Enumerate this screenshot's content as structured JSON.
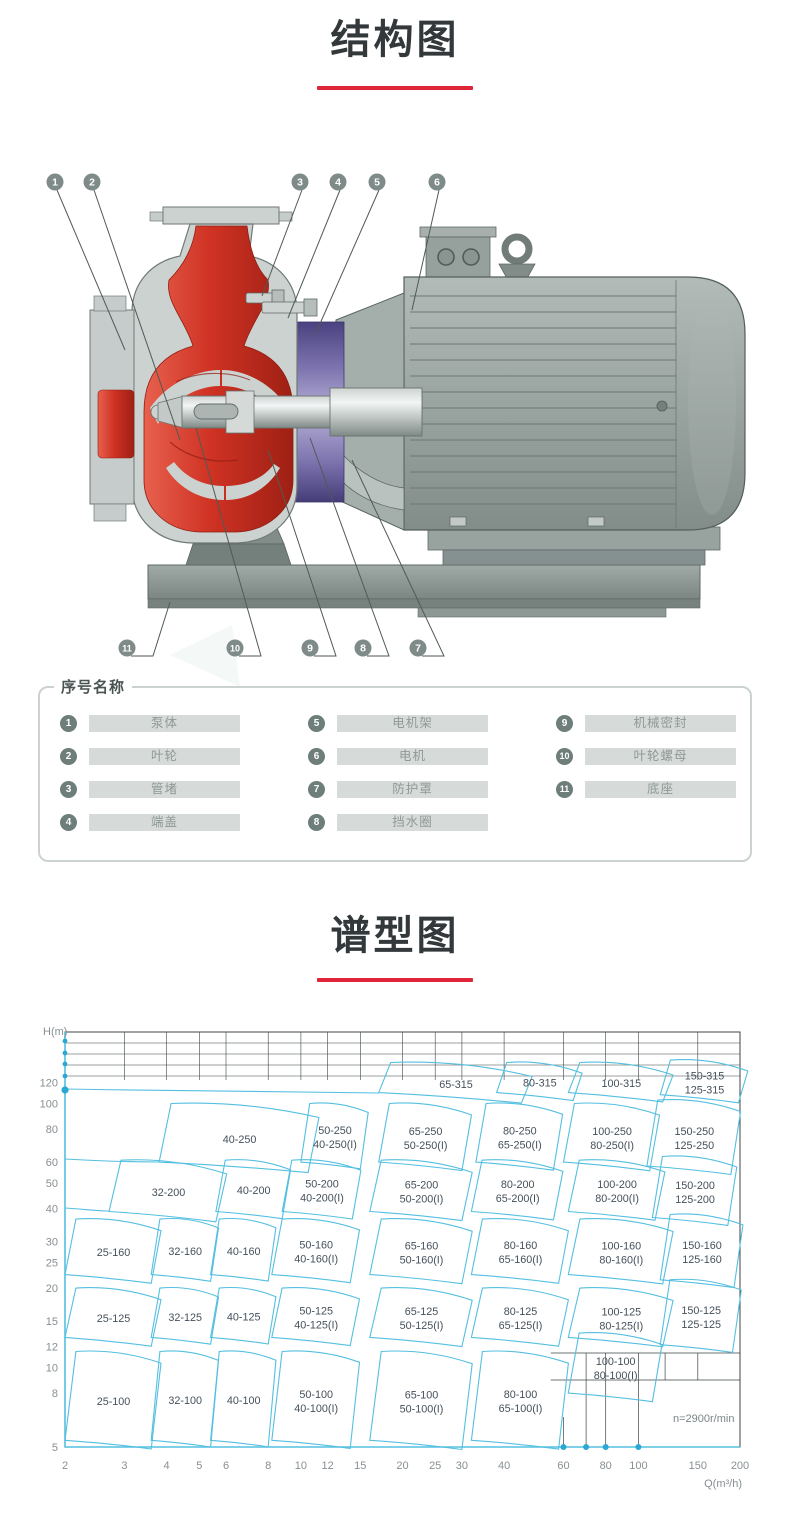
{
  "titles": {
    "structure": "结构图",
    "type_chart": "谱型图"
  },
  "colors": {
    "accent_red": "#e0243a",
    "chart_line": "#54bfe0",
    "chart_dot": "#2ba7d4",
    "grid_black": "#3d4546",
    "region_text": "#45505a",
    "tick_text": "#878f93"
  },
  "legend": {
    "title": "序号名称",
    "columns": [
      [
        {
          "num": "1",
          "label": "泵体"
        },
        {
          "num": "2",
          "label": "叶轮"
        },
        {
          "num": "3",
          "label": "管堵"
        },
        {
          "num": "4",
          "label": "端盖"
        }
      ],
      [
        {
          "num": "5",
          "label": "电机架"
        },
        {
          "num": "6",
          "label": "电机"
        },
        {
          "num": "7",
          "label": "防护罩"
        },
        {
          "num": "8",
          "label": "挡水圈"
        }
      ],
      [
        {
          "num": "9",
          "label": "机械密封"
        },
        {
          "num": "10",
          "label": "叶轮螺母"
        },
        {
          "num": "11",
          "label": "底座"
        }
      ]
    ]
  },
  "pump": {
    "callouts_top": [
      {
        "n": "1",
        "cx": 55,
        "cy": 32,
        "tx": 125,
        "ty": 200
      },
      {
        "n": "2",
        "cx": 92,
        "cy": 32,
        "tx": 180,
        "ty": 290
      },
      {
        "n": "3",
        "cx": 300,
        "cy": 32,
        "tx": 262,
        "ty": 146
      },
      {
        "n": "4",
        "cx": 338,
        "cy": 32,
        "tx": 288,
        "ty": 168
      },
      {
        "n": "5",
        "cx": 377,
        "cy": 32,
        "tx": 315,
        "ty": 185
      },
      {
        "n": "6",
        "cx": 437,
        "cy": 32,
        "tx": 412,
        "ty": 160
      }
    ],
    "callouts_bottom": [
      {
        "n": "11",
        "cx": 127,
        "cy": 498,
        "tx": 170,
        "ty": 452
      },
      {
        "n": "10",
        "cx": 235,
        "cy": 498,
        "tx": 196,
        "ty": 278
      },
      {
        "n": "9",
        "cx": 310,
        "cy": 498,
        "tx": 268,
        "ty": 300
      },
      {
        "n": "8",
        "cx": 363,
        "cy": 498,
        "tx": 310,
        "ty": 288
      },
      {
        "n": "7",
        "cx": 418,
        "cy": 498,
        "tx": 352,
        "ty": 310
      }
    ]
  },
  "chart_data": {
    "type": "region-map",
    "x_axis": {
      "label": "Q(m³/h)",
      "scale": "log",
      "range": [
        2,
        200
      ],
      "ticks": [
        2,
        3,
        4,
        5,
        6,
        8,
        10,
        12,
        15,
        20,
        25,
        30,
        40,
        60,
        80,
        100,
        150,
        200
      ]
    },
    "y_axis": {
      "label": "H(m)",
      "scale": "log",
      "range": [
        5,
        140
      ],
      "ticks": [
        5,
        8,
        10,
        12,
        15,
        20,
        25,
        30,
        40,
        50,
        60,
        80,
        100,
        120
      ]
    },
    "annotation": "n=2900r/min",
    "axis_dots_q": [
      60,
      70,
      80,
      100
    ],
    "regions": [
      {
        "labels": [
          "65-315"
        ],
        "q": [
          17,
          45
        ],
        "h": [
          110,
          143
        ]
      },
      {
        "labels": [
          "80-315"
        ],
        "q": [
          38,
          64
        ],
        "h": [
          110,
          143
        ]
      },
      {
        "labels": [
          "100-315"
        ],
        "q": [
          62,
          118
        ],
        "h": [
          110,
          143
        ]
      },
      {
        "labels": [
          "150-315",
          "125-315"
        ],
        "q": [
          116,
          198
        ],
        "h": [
          108,
          146
        ]
      },
      {
        "labels": [
          "40-250"
        ],
        "q": [
          3.8,
          10.5
        ],
        "h": [
          60,
          100
        ]
      },
      {
        "labels": [
          "50-250",
          "40-250(I)"
        ],
        "q": [
          10,
          15
        ],
        "h": [
          60,
          100
        ]
      },
      {
        "labels": [
          "65-250",
          "50-250(I)"
        ],
        "q": [
          17,
          30
        ],
        "h": [
          60,
          100
        ]
      },
      {
        "labels": [
          "80-250",
          "65-250(I)"
        ],
        "q": [
          33,
          56
        ],
        "h": [
          60,
          100
        ]
      },
      {
        "labels": [
          "100-250",
          "80-250(I)"
        ],
        "q": [
          60,
          108
        ],
        "h": [
          60,
          100
        ]
      },
      {
        "labels": [
          "150-250",
          "125-250"
        ],
        "q": [
          106,
          188
        ],
        "h": [
          58,
          103
        ]
      },
      {
        "labels": [
          "32-200"
        ],
        "q": [
          2.7,
          5.6
        ],
        "h": [
          39,
          61
        ]
      },
      {
        "labels": [
          "40-200"
        ],
        "q": [
          5.6,
          8.8
        ],
        "h": [
          39,
          61
        ]
      },
      {
        "labels": [
          "50-200",
          "40-200(I)"
        ],
        "q": [
          8.8,
          14.2
        ],
        "h": [
          39,
          61
        ]
      },
      {
        "labels": [
          "65-200",
          "50-200(I)"
        ],
        "q": [
          16,
          30
        ],
        "h": [
          39,
          61
        ]
      },
      {
        "labels": [
          "80-200",
          "65-200(I)"
        ],
        "q": [
          32,
          56
        ],
        "h": [
          39,
          61
        ]
      },
      {
        "labels": [
          "100-200",
          "80-200(I)"
        ],
        "q": [
          62,
          112
        ],
        "h": [
          39,
          61
        ]
      },
      {
        "labels": [
          "150-200",
          "125-200"
        ],
        "q": [
          110,
          184
        ],
        "h": [
          37,
          63
        ]
      },
      {
        "labels": [
          "25-160"
        ],
        "q": [
          2,
          3.6
        ],
        "h": [
          22.5,
          36.5
        ]
      },
      {
        "labels": [
          "32-160"
        ],
        "q": [
          3.6,
          5.4
        ],
        "h": [
          22.5,
          36.5
        ]
      },
      {
        "labels": [
          "40-160"
        ],
        "q": [
          5.4,
          8
        ],
        "h": [
          22.5,
          36.5
        ]
      },
      {
        "labels": [
          "50-160",
          "40-160(I)"
        ],
        "q": [
          8.2,
          14
        ],
        "h": [
          22.5,
          36.5
        ]
      },
      {
        "labels": [
          "65-160",
          "50-160(I)"
        ],
        "q": [
          16,
          30
        ],
        "h": [
          22.5,
          36.5
        ]
      },
      {
        "labels": [
          "80-160",
          "65-160(I)"
        ],
        "q": [
          32,
          58
        ],
        "h": [
          22.5,
          36.5
        ]
      },
      {
        "labels": [
          "100-160",
          "80-160(I)"
        ],
        "q": [
          62,
          118
        ],
        "h": [
          22.5,
          36.5
        ]
      },
      {
        "labels": [
          "150-160",
          "125-160"
        ],
        "q": [
          116,
          192
        ],
        "h": [
          21.5,
          38
        ]
      },
      {
        "labels": [
          "25-125"
        ],
        "q": [
          2,
          3.6
        ],
        "h": [
          13,
          20
        ]
      },
      {
        "labels": [
          "32-125"
        ],
        "q": [
          3.6,
          5.4
        ],
        "h": [
          13,
          20
        ]
      },
      {
        "labels": [
          "40-125"
        ],
        "q": [
          5.4,
          8
        ],
        "h": [
          13,
          20
        ]
      },
      {
        "labels": [
          "50-125",
          "40-125(I)"
        ],
        "q": [
          8.2,
          14
        ],
        "h": [
          13,
          20
        ]
      },
      {
        "labels": [
          "65-125",
          "50-125(I)"
        ],
        "q": [
          16,
          30
        ],
        "h": [
          13,
          20
        ]
      },
      {
        "labels": [
          "80-125",
          "65-125(I)"
        ],
        "q": [
          32,
          58
        ],
        "h": [
          13,
          20
        ]
      },
      {
        "labels": [
          "100-125",
          "80-125(I)"
        ],
        "q": [
          62,
          118
        ],
        "h": [
          13,
          20
        ]
      },
      {
        "labels": [
          "150-125",
          "125-125"
        ],
        "q": [
          116,
          190
        ],
        "h": [
          12.2,
          21.5
        ]
      },
      {
        "labels": [
          "25-100"
        ],
        "q": [
          2,
          3.6
        ],
        "h": [
          5.3,
          11.5
        ]
      },
      {
        "labels": [
          "32-100"
        ],
        "q": [
          3.6,
          5.4
        ],
        "h": [
          5.3,
          11.5
        ]
      },
      {
        "labels": [
          "40-100"
        ],
        "q": [
          5.4,
          8
        ],
        "h": [
          5.3,
          11.5
        ]
      },
      {
        "labels": [
          "50-100",
          "40-100(I)"
        ],
        "q": [
          8.2,
          14
        ],
        "h": [
          5.3,
          11.5
        ]
      },
      {
        "labels": [
          "65-100",
          "50-100(I)"
        ],
        "q": [
          16,
          30
        ],
        "h": [
          5.3,
          11.5
        ]
      },
      {
        "labels": [
          "80-100",
          "65-100(I)"
        ],
        "q": [
          32,
          58
        ],
        "h": [
          5.3,
          11.5
        ]
      },
      {
        "labels": [
          "100-100",
          "80-100(I)"
        ],
        "q": [
          62,
          110
        ],
        "h": [
          8,
          13.5
        ]
      }
    ]
  }
}
